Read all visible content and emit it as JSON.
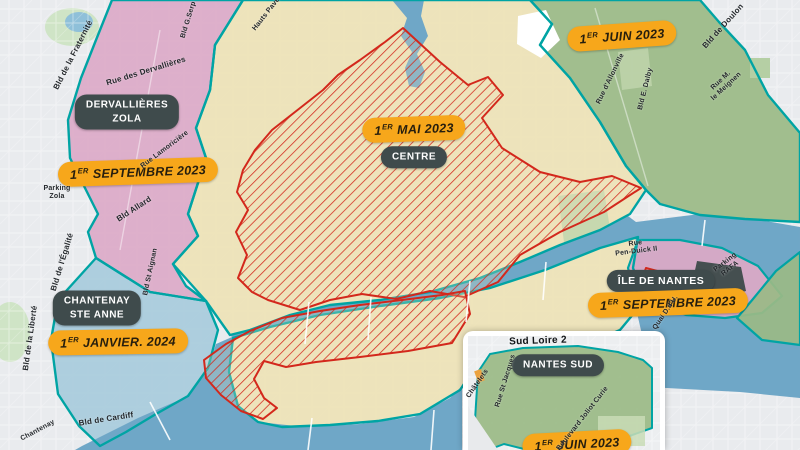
{
  "zones": {
    "dervallieres_zola": {
      "name_line1": "DERVALLIÈRES",
      "name_line2": "ZOLA",
      "date_num": "1",
      "date_sup": "ER",
      "date_rest": "SEPTEMBRE 2023"
    },
    "centre": {
      "name": "CENTRE",
      "date_num": "1",
      "date_sup": "ER",
      "date_rest": "MAI 2023"
    },
    "doulon_nord_est": {
      "date_num": "1",
      "date_sup": "ER",
      "date_rest": "JUIN 2023"
    },
    "chantenay_ste_anne": {
      "name_line1": "CHANTENAY",
      "name_line2": "STE ANNE",
      "date_num": "1",
      "date_sup": "ER",
      "date_rest": "JANVIER. 2024"
    },
    "ile_de_nantes": {
      "name": "ÎLE DE NANTES",
      "date_num": "1",
      "date_sup": "ER",
      "date_rest": "SEPTEMBRE 2023"
    },
    "nantes_sud": {
      "inset_title": "Sud Loire 2",
      "name": "NANTES SUD",
      "date_num": "1",
      "date_sup": "ER",
      "date_rest": "JUIN 2023"
    }
  },
  "streets": {
    "fraternite": "Bld de la Fraternité",
    "dervallieres": "Rue des Dervallières",
    "serpette": "Bld G.Serp",
    "hauts_paves": "Hauts Pavés",
    "lamoriciere": "Rue Lamoricière",
    "parking_zola_1": "Parking",
    "parking_zola_2": "Zola",
    "allard": "Bld Allard",
    "st_aignan": "Bld St Aignan",
    "egalite": "Bld de l'Égalité",
    "liberte": "Bld de la Liberté",
    "cardiff": "Bld de Cardiff",
    "chantenay": "Chantenay",
    "doulon": "Bld de Doulon",
    "allonville": "Rue d'Allonville",
    "dalby": "Bld E. Dalby",
    "meignen_1": "Rue M.",
    "meignen_2": "le Meignen",
    "pen_duick_1": "Rue",
    "pen_duick_2": "Pen-Duick II",
    "parking_rafa_1": "Parking",
    "parking_rafa_2": "RAFA",
    "quai": "Quai D.d'U.",
    "chatelets": "Châtelets",
    "st_jacques": "Rue St Jacques",
    "joliot_curie": "Boulevard Joliot Curie"
  },
  "colors": {
    "boundary_teal": "#00a4a4",
    "hatch_red": "#d3281c",
    "date_pill_orange": "#f7a71b",
    "name_pill_dark": "#3f4b4c",
    "zone_pink": "#dca9c6",
    "zone_beige": "#ede2b5",
    "zone_blue": "#a6cbdc",
    "zone_green": "#9aba86",
    "water_blue": "#6fa7c7"
  }
}
